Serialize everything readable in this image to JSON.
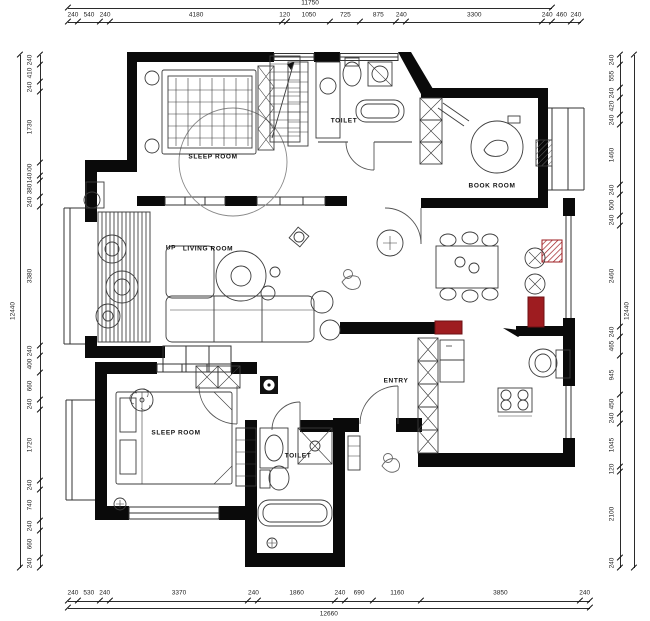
{
  "rooms": {
    "sleep_room_top": "SLEEP ROOM",
    "toilet_top": "TOILET",
    "book_room": "BOOK ROOM",
    "living_room": "LIVING ROOM",
    "up": "UP",
    "entry": "ENTRY",
    "sleep_room_bottom": "SLEEP ROOM",
    "toilet_bottom": "TOILET"
  },
  "dimensions": {
    "top": {
      "total": "11750",
      "segments": [
        "240",
        "540",
        "240",
        "4180",
        "120",
        "1050",
        "725",
        "875",
        "240",
        "3300",
        "240",
        "460",
        "240"
      ]
    },
    "bottom": {
      "total": "12660",
      "segments": [
        "240",
        "530",
        "240",
        "3370",
        "240",
        "1860",
        "240",
        "690",
        "1160",
        "3850",
        "240"
      ]
    },
    "left": {
      "total": "12440",
      "segments": [
        "240",
        "410",
        "240",
        "1730",
        "300",
        "140",
        "380",
        "240",
        "3380",
        "240",
        "400",
        "660",
        "240",
        "1720",
        "240",
        "740",
        "240",
        "660",
        "240"
      ]
    },
    "right": {
      "total": "12440",
      "segments": [
        "240",
        "555",
        "240",
        "420",
        "240",
        "1460",
        "240",
        "500",
        "240",
        "2460",
        "240",
        "465",
        "945",
        "450",
        "240",
        "1045",
        "120",
        "2100",
        "240"
      ]
    }
  },
  "colors": {
    "wall": "#0a0a0a",
    "line": "#333333",
    "accent_red": "#9e1c20"
  }
}
